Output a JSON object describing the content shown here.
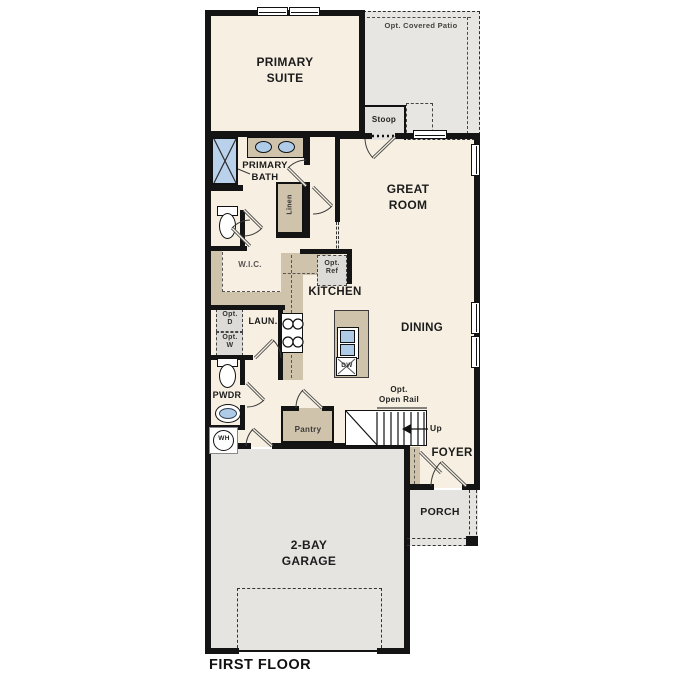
{
  "title": "FIRST FLOOR",
  "floor_plan": {
    "labels": {
      "primary_suite": "PRIMARY\nSUITE",
      "opt_covered_patio": "Opt. Covered Patio",
      "stoop": "Stoop",
      "great_room": "GREAT\nROOM",
      "primary_bath": "PRIMARY\nBATH",
      "linen": "Linen",
      "wic": "W.I.C.",
      "opt_dryer": "Opt.\nD",
      "opt_washer": "Opt.\nW",
      "laundry": "LAUN.",
      "kitchen": "KITCHEN",
      "opt_ref": "Opt.\nRef",
      "dining": "DINING",
      "pwdr": "PWDR",
      "water_heater": "WH",
      "pantry": "Pantry",
      "opt_open_rail": "Opt.\nOpen Rail",
      "up": "Up",
      "dishwasher": "DW",
      "foyer": "FOYER",
      "porch": "PORCH",
      "garage": "2-BAY\nGARAGE",
      "floor_title": "FIRST FLOOR"
    },
    "colors": {
      "wall": "#141414",
      "interior": "#f7f0e2",
      "concrete_gray": "#e5e4e1",
      "casework_tan": "#d0c3ab",
      "fixture_blue": "#aecbe8",
      "label_text": "#1c1c1c"
    }
  }
}
